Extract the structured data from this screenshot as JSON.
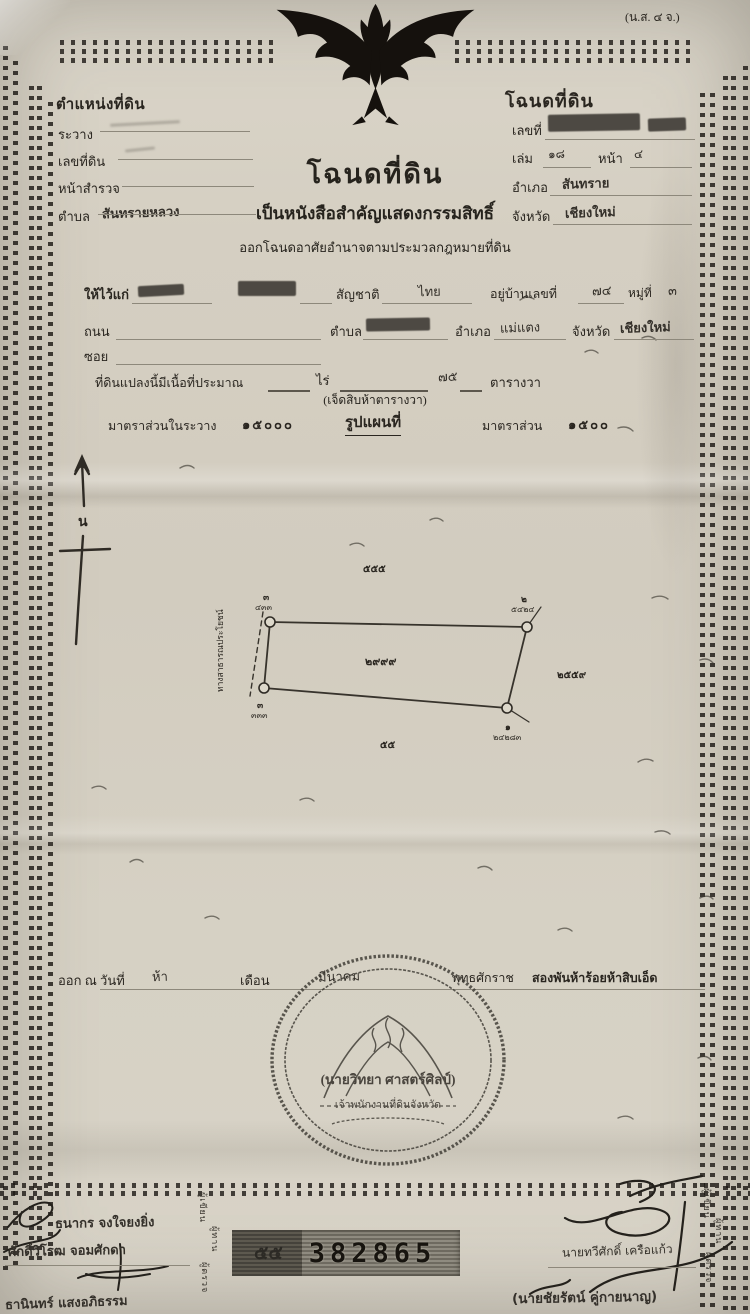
{
  "header": {
    "form_code": "(น.ส. ๔ จ.)"
  },
  "position_block": {
    "title": "ตำแหน่งที่ดิน",
    "rawang_label": "ระวาง",
    "land_no_label": "เลขที่ดิน",
    "survey_page_label": "หน้าสำรวจ",
    "tambon_label": "ตำบล",
    "tambon_value": "สันทรายหลวง"
  },
  "deed_block": {
    "title": "โฉนดที่ดิน",
    "no_label": "เลขที่",
    "volume_label": "เล่ม",
    "volume_value": "๑๘",
    "page_label": "หน้า",
    "page_value": "๔",
    "amphoe_label": "อำเภอ",
    "amphoe_value": "สันทราย",
    "province_label": "จังหวัด",
    "province_value": "เชียงใหม่"
  },
  "title_block": {
    "title": "โฉนดที่ดิน",
    "subtitle": "เป็นหนังสือสำคัญแสดงกรรมสิทธิ์",
    "authority": "ออกโฉนดอาศัยอำนาจตามประมวลกฎหมายที่ดิน"
  },
  "grantee": {
    "given_label": "ให้ไว้แก่",
    "nationality_label": "สัญชาติ",
    "nationality_value": "ไทย",
    "address_label": "อยู่บ้านเลขที่",
    "house_no": "๗๔",
    "moo_label": "หมู่ที่",
    "moo_value": "๓",
    "road_label": "ถนน",
    "tambon_label": "ตำบล",
    "amphoe_label": "อำเภอ",
    "amphoe_value": "แม่แตง",
    "province_label": "จังหวัด",
    "province_value": "เชียงใหม่",
    "soi_label": "ซอย"
  },
  "area": {
    "label": "ที่ดินแปลงนี้มีเนื้อที่ประมาณ",
    "rai_label": "ไร่",
    "wa_value": "๗๕",
    "wa_label": "ตารางวา",
    "words": "(เจ็ดสิบห้าตารางวา)"
  },
  "scales": {
    "sheet_label": "มาตราส่วนในระวาง",
    "sheet_value": "๑๕๐๐๐",
    "map_title": "รูปแผนที่",
    "scale_label": "มาตราส่วน",
    "scale_value": "๑๕๐๐"
  },
  "compass": {
    "north": "น"
  },
  "plot": {
    "parcel": "๒๙๙๙",
    "top_distance": "๕๕๕",
    "bottom_distance": "๕๕",
    "right_parcel": "๒๕๕๙",
    "road": "ทางสาธารณประโยชน์",
    "c_tl_id": "๓",
    "c_tl_ref": "๔๓๓",
    "c_bl_id": "๓",
    "c_bl_ref": "๓๓๓",
    "c_tr_id": "๒",
    "c_tr_ref": "๕๔๒๔",
    "c_br_id": "๑",
    "c_br_ref": "๒๔๒๘๓"
  },
  "issue": {
    "prefix": "ออก ณ วันที่",
    "day": "ห้า",
    "month_label": "เดือน",
    "month": "มีนาคม",
    "era_label": "พุทธศักราช",
    "year_words": "สองพันห้าร้อยห้าสิบเอ็ด"
  },
  "seal": {
    "signatory": "(นายวิทยา ศาสตร์ศิลป์)",
    "position": "เจ้าพนักงานที่ดินจังหวัด"
  },
  "serial": {
    "prefix": "๕๕",
    "number": "382865"
  },
  "signatures": {
    "left1": "ธนากร จงใจยงยิ่ง",
    "left2": "ศักดิ์วิโรฒ จอมศักดา",
    "left3": "ธานินทร์ แสงอภิธรรม",
    "right1": "นายทวีศักดิ์ เครือแก้ว",
    "right2": "(นายชัยรัตน์ คู่กายนาญ)"
  },
  "roles": {
    "writer": "ผู้เขียน",
    "reader": "ผู้ทาน",
    "examiner": "ผู้ตรวจ"
  }
}
